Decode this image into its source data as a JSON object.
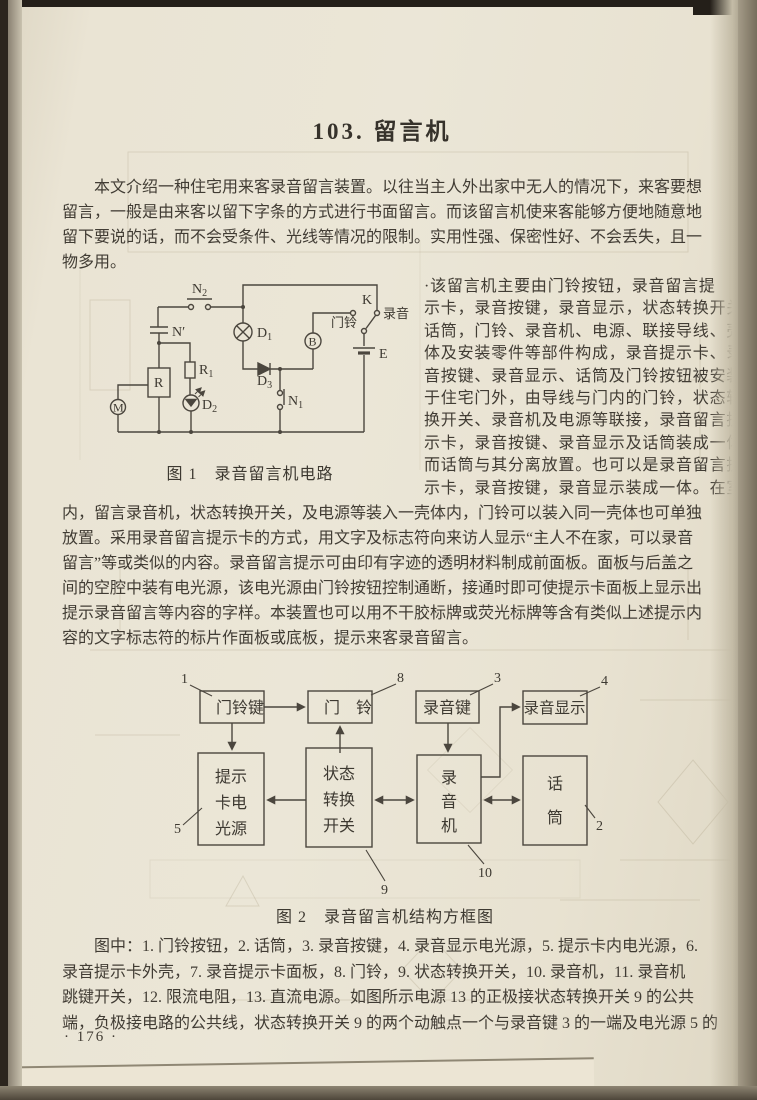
{
  "page": {
    "title": "103. 留言机",
    "page_number": "· 176 ·"
  },
  "intro": {
    "lines": [
      "本文介绍一种住宅用来客录音留言装置。以往当主人外出家中无人的情况下，来客要想",
      "留言，一般是由来客以留下字条的方式进行书面留言。而该留言机使来客能够方便地随意地",
      "留下要说的话，而不会受条件、光线等情况的限制。实用性强、保密性好、不会丢失，且一",
      "物多用。"
    ]
  },
  "right_column": {
    "lines": [
      "·该留言机主要由门铃按钮，录音留言提",
      "示卡，录音按键，录音显示，状态转换开关，",
      "话筒，门铃、录音机、电源、联接导线、壳",
      "体及安装零件等部件构成，录音提示卡、录",
      "音按键、录音显示、话筒及门铃按钮被安装",
      "于住宅门外，由导线与门内的门铃，状态转",
      "换开关、录音机及电源等联接，录音留言提",
      "示卡，录音按键、录音显示及话筒装成一体，",
      "而话筒与其分离放置。也可以是录音留言提",
      "示卡，录音按键，录音显示装成一体。在室"
    ]
  },
  "body2": {
    "lines": [
      "内，留言录音机，状态转换开关，及电源等装入一壳体内，门铃可以装入同一壳体也可单独",
      "放置。采用录音留言提示卡的方式，用文字及标志符向来访人显示“主人不在家，可以录音",
      "留言”等或类似的内容。录音留言提示可由印有字迹的透明材料制成前面板。面板与后盖之",
      "间的空腔中装有电光源，该电光源由门铃按钮控制通断，接通时即可使提示卡面板上显示出",
      "提示录音留言等内容的字样。本装置也可以用不干胶标牌或荧光标牌等含有类似上述提示内",
      "容的文字标志符的标片作面板或底板，提示来客录音留言。"
    ]
  },
  "figure1": {
    "caption": "图 1　录音留言机电路",
    "labels": {
      "n2": {
        "base": "N",
        "sub": "2"
      },
      "nprime": "N′",
      "r": "R",
      "r1": {
        "base": "R",
        "sub": "1"
      },
      "d2": {
        "base": "D",
        "sub": "2"
      },
      "m": "M",
      "d1": {
        "base": "D",
        "sub": "1"
      },
      "d3": {
        "base": "D",
        "sub": "3"
      },
      "n1": {
        "base": "N",
        "sub": "1"
      },
      "b": "B",
      "k": "K",
      "e": "E",
      "doorbell": "门铃",
      "record": "录音"
    }
  },
  "figure2": {
    "caption": "图 2　录音留言机结构方框图",
    "boxes": {
      "doorbell_key": {
        "label": "门铃键",
        "number": "1"
      },
      "doorbell": {
        "label": "门　铃",
        "number": "8"
      },
      "record_key": {
        "label": "录音键",
        "number": "3"
      },
      "record_display": {
        "label": "录音显示",
        "number": "4"
      },
      "prompt_card_light": {
        "lines": [
          "提示",
          "卡电",
          "光源"
        ],
        "number": "5"
      },
      "state_switch": {
        "lines": [
          "状态",
          "转换",
          "开关"
        ],
        "number": "9"
      },
      "recorder": {
        "lines": [
          "录",
          "音",
          "机"
        ],
        "number": "10"
      },
      "microphone": {
        "lines": [
          "话",
          "筒"
        ],
        "number": "2"
      }
    }
  },
  "legend": {
    "lines": [
      "图中：1. 门铃按钮，2. 话筒，3. 录音按键，4. 录音显示电光源，5. 提示卡内电光源，6.",
      "录音提示卡外壳，7. 录音提示卡面板，8. 门铃，9. 状态转换开关，10. 录音机，11. 录音机",
      "跳键开关，12. 限流电阻，13. 直流电源。如图所示电源 13 的正极接状态转换开关 9 的公共",
      "端，负极接电路的公共线，状态转换开关 9 的两个动触点一个与录音键 3 的一端及电光源 5 的"
    ]
  }
}
